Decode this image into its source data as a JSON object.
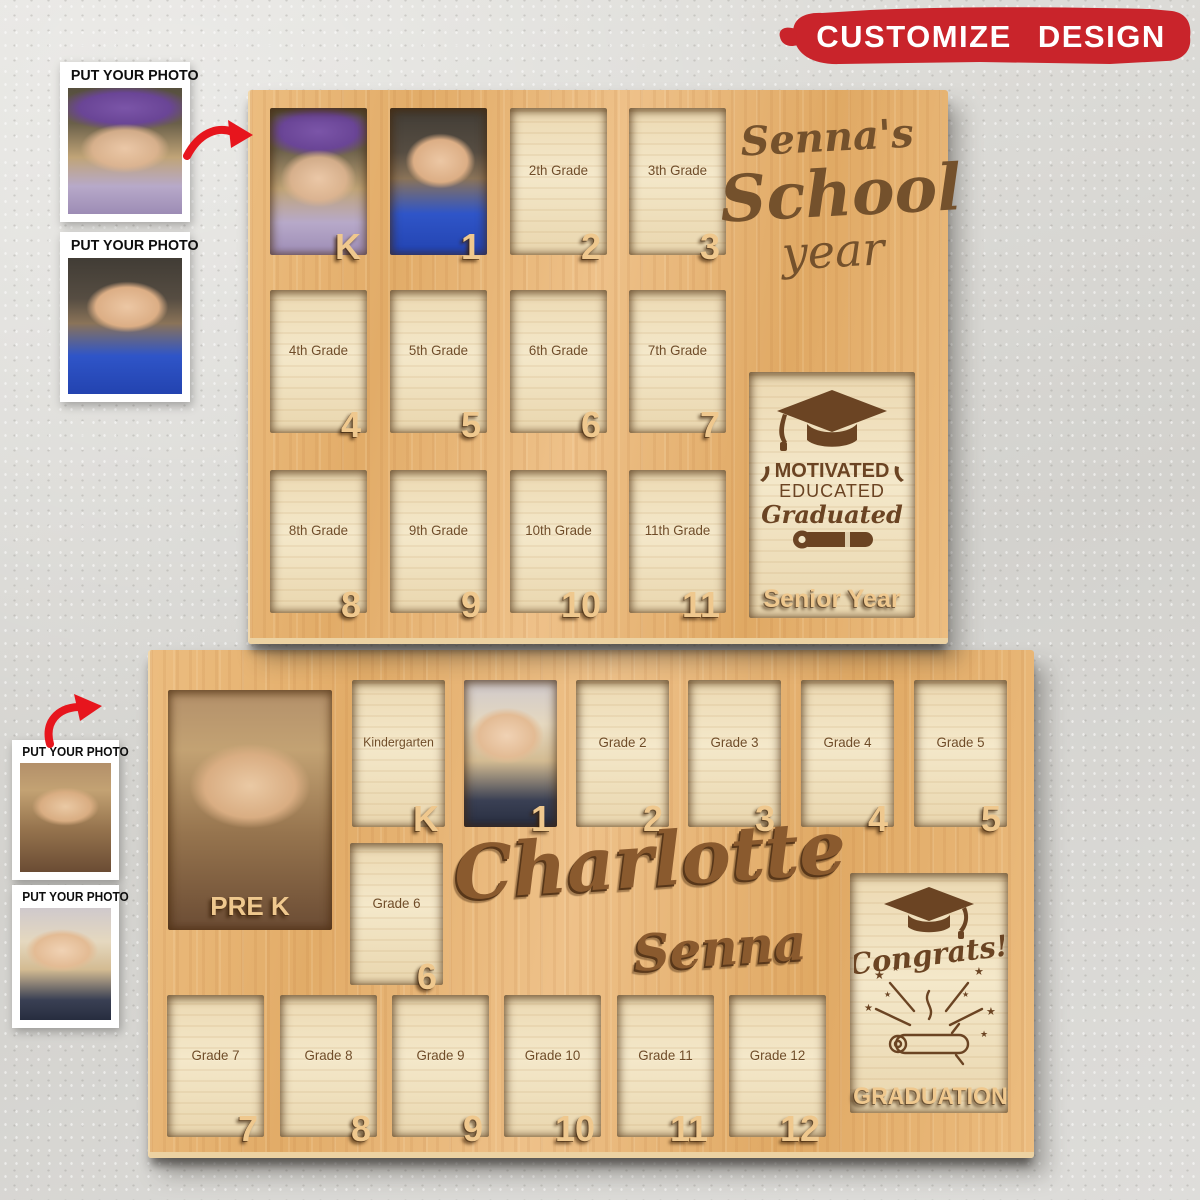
{
  "banner": {
    "label": "CUSTOMIZE DESIGN"
  },
  "colors": {
    "banner_red": "#c9242b",
    "board_wood": "#e7b678",
    "slot_wood": "#efdfba",
    "engraving_brown": "#6b4423",
    "raised_wood": "#efc88e"
  },
  "photo_cards": [
    {
      "label": "PUT YOUR PHOTO",
      "photo": "girl-flower-crown"
    },
    {
      "label": "PUT YOUR PHOTO",
      "photo": "girl-blue-dress"
    },
    {
      "label": "PUT YOUR PHOTO",
      "photo": "girl-warm-portrait"
    },
    {
      "label": "PUT YOUR PHOTO",
      "photo": "girl-blonde"
    }
  ],
  "board_top": {
    "title": {
      "line1": "Senna's",
      "line2": "School",
      "line3": "year"
    },
    "slots": [
      {
        "label": "",
        "number": "K",
        "has_photo": true
      },
      {
        "label": "",
        "number": "1",
        "has_photo": true
      },
      {
        "label": "2th Grade",
        "number": "2",
        "has_photo": false
      },
      {
        "label": "3th Grade",
        "number": "3",
        "has_photo": false
      },
      {
        "label": "4th Grade",
        "number": "4",
        "has_photo": false
      },
      {
        "label": "5th Grade",
        "number": "5",
        "has_photo": false
      },
      {
        "label": "6th Grade",
        "number": "6",
        "has_photo": false
      },
      {
        "label": "7th Grade",
        "number": "7",
        "has_photo": false
      },
      {
        "label": "8th Grade",
        "number": "8",
        "has_photo": false
      },
      {
        "label": "9th Grade",
        "number": "9",
        "has_photo": false
      },
      {
        "label": "10th Grade",
        "number": "10",
        "has_photo": false
      },
      {
        "label": "11th Grade",
        "number": "11",
        "has_photo": false
      }
    ],
    "senior_slot": {
      "line1": "MOTIVATED",
      "line2": "EDUCATED",
      "line3": "Graduated",
      "caption": "Senior Year"
    }
  },
  "board_bottom": {
    "name": {
      "line1": "Charlotte",
      "line2": "Senna"
    },
    "prek_slot": {
      "caption": "PRE K",
      "has_photo": true
    },
    "slots_row1": [
      {
        "label": "Kindergarten",
        "number": "K",
        "has_photo": false
      },
      {
        "label": "",
        "number": "1",
        "has_photo": true
      },
      {
        "label": "Grade 2",
        "number": "2",
        "has_photo": false
      },
      {
        "label": "Grade 3",
        "number": "3",
        "has_photo": false
      },
      {
        "label": "Grade 4",
        "number": "4",
        "has_photo": false
      },
      {
        "label": "Grade 5",
        "number": "5",
        "has_photo": false
      }
    ],
    "grade6_slot": {
      "label": "Grade 6",
      "number": "6",
      "has_photo": false
    },
    "slots_row2": [
      {
        "label": "Grade 7",
        "number": "7",
        "has_photo": false
      },
      {
        "label": "Grade 8",
        "number": "8",
        "has_photo": false
      },
      {
        "label": "Grade 9",
        "number": "9",
        "has_photo": false
      },
      {
        "label": "Grade 10",
        "number": "10",
        "has_photo": false
      },
      {
        "label": "Grade 11",
        "number": "11",
        "has_photo": false
      },
      {
        "label": "Grade 12",
        "number": "12",
        "has_photo": false
      }
    ],
    "graduation_slot": {
      "headline": "Congrats!",
      "caption": "GRADUATION"
    }
  }
}
